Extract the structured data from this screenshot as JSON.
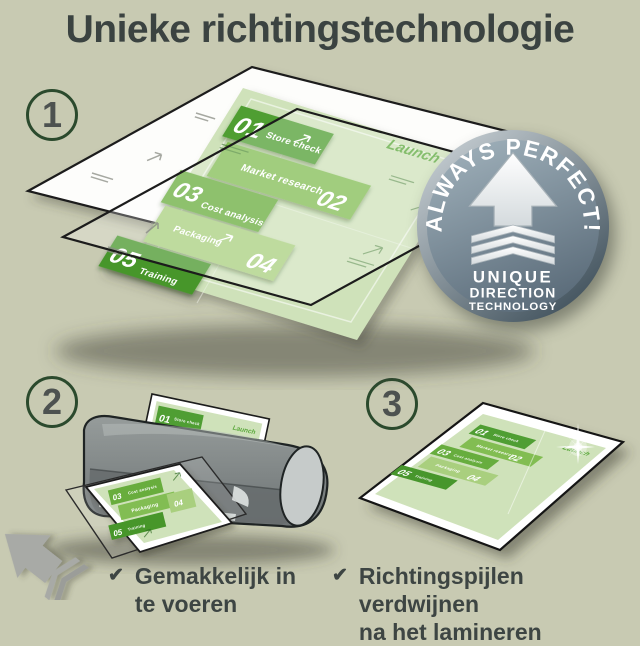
{
  "title": "Unieke richtingstechnologie",
  "steps": [
    {
      "number": "1"
    },
    {
      "number": "2"
    },
    {
      "number": "3"
    }
  ],
  "badge": {
    "arc_text": "ALWAYS PERFECT!",
    "line1": "UNIQUE",
    "line2": "DIRECTION",
    "line3": "TECHNOLOGY"
  },
  "document": {
    "launch_label": "Launch",
    "items": [
      {
        "num": "01",
        "label": "Store check"
      },
      {
        "num": "02",
        "label": "Market research"
      },
      {
        "num": "03",
        "label": "Cost analysis"
      },
      {
        "num": "04",
        "label": "Packaging"
      },
      {
        "num": "05",
        "label": "Training"
      }
    ]
  },
  "bullets": [
    {
      "check": "✔",
      "line1": "Gemakkelijk in",
      "line2": "te voeren"
    },
    {
      "check": "✔",
      "line1": "Richtingspijlen verdwijnen",
      "line2": "na het lamineren"
    }
  ],
  "colors": {
    "background": "#c8cab2",
    "text": "#3d4543",
    "circle_ring": "#2b4a2d",
    "doc_bg": "#cfe2ba",
    "band_01": "#4f9e33",
    "band_02": "#82bd52",
    "band_03": "#67ad3e",
    "band_04": "#a9cf7e",
    "band_05": "#47962c",
    "launch_green": "#5ba83c",
    "badge_face_top": "#9fb0ba",
    "badge_face_bottom": "#5b6c7a",
    "badge_rim_light": "#d3dade",
    "badge_rim_dark": "#3f505b",
    "laminator_gray": "#7d8384",
    "arrow_gray": "#a8aaa6",
    "pouch_white": "#fdfdfb"
  }
}
